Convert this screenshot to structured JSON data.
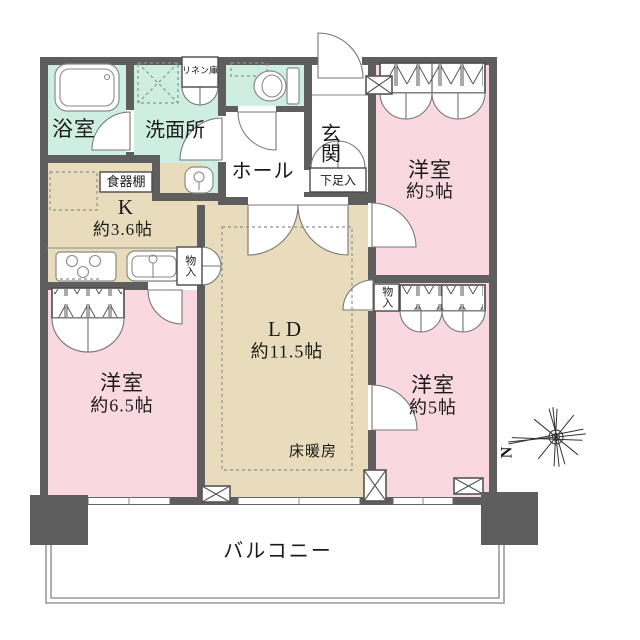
{
  "floorplan": {
    "title": "apartment-floor-plan",
    "rooms": {
      "bath": {
        "label": "浴室"
      },
      "washroom": {
        "label": "洗面所"
      },
      "linen": {
        "label": "リネン庫"
      },
      "entrance": {
        "label": "玄関"
      },
      "shoe_box": {
        "label": "下足入"
      },
      "hall": {
        "label": "ホール"
      },
      "kitchen": {
        "label": "K",
        "size": "約3.6帖",
        "cupboard": "食器棚"
      },
      "living_dining": {
        "label": "LD",
        "size": "約11.5帖",
        "floor_heating": "床暖房"
      },
      "bedroom_top_right": {
        "label": "洋室",
        "size": "約5帖"
      },
      "bedroom_bottom_right": {
        "label": "洋室",
        "size": "約5帖"
      },
      "bedroom_left": {
        "label": "洋室",
        "size": "約6.5帖"
      },
      "storage_left": {
        "label": "物入"
      },
      "storage_right": {
        "label": "物入"
      },
      "balcony": {
        "label": "バルコニー"
      }
    },
    "compass": {
      "label": "N"
    },
    "colors": {
      "wall": "#5e5e5f",
      "wet_area": "#cfeee2",
      "bedroom": "#f9d8e2",
      "living": "#e8dcbc",
      "balcony_line": "#9a9a9a"
    }
  }
}
